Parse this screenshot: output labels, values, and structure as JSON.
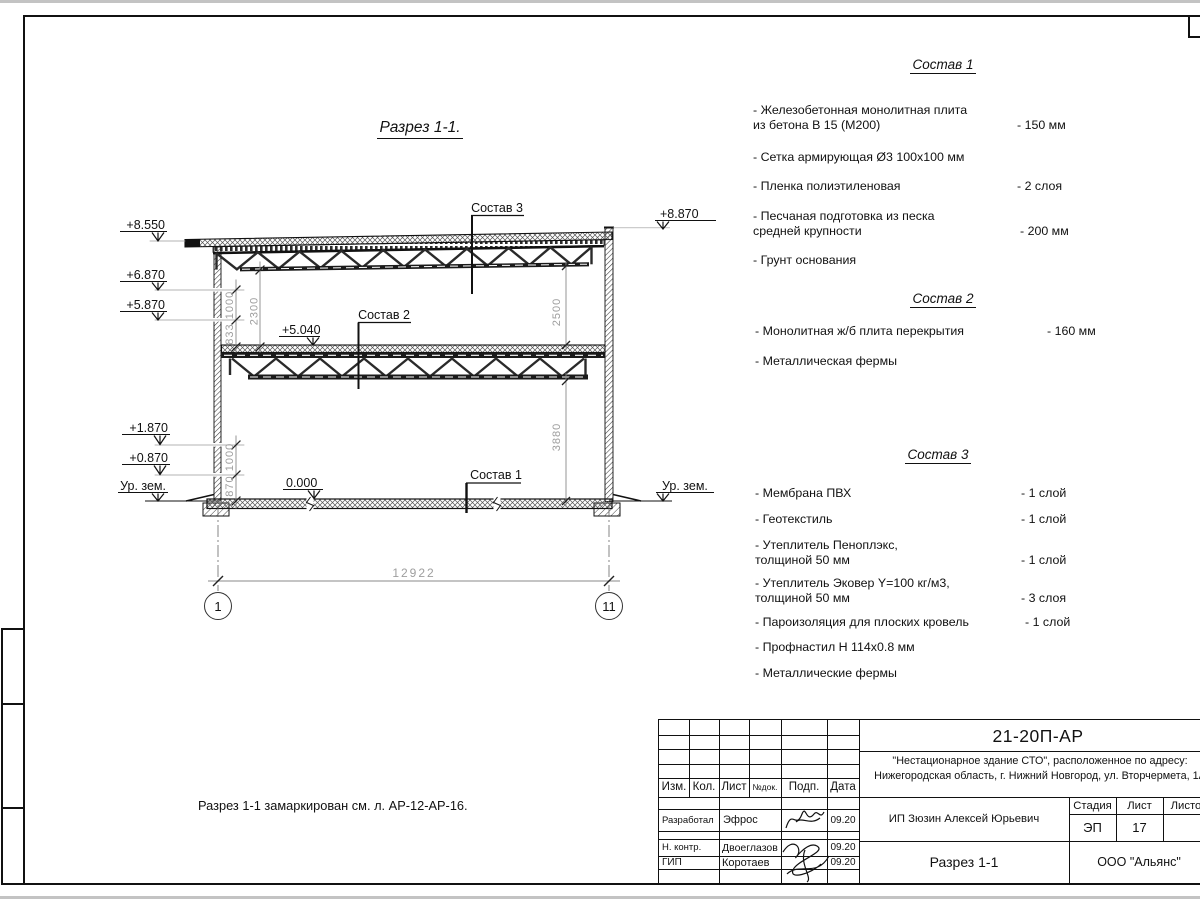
{
  "drawing": {
    "title": "Разрез 1-1.",
    "note": "Разрез 1-1 замаркирован см. л. АР-12-АР-16.",
    "callouts": {
      "sostav1": "Состав 1",
      "sostav2": "Состав 2",
      "sostav3": "Состав 3"
    },
    "elevations": {
      "left": [
        "+8.550",
        "+6.870",
        "+5.870",
        "+1.870",
        "+0.870",
        "Ур. зем."
      ],
      "right_top": "+8.870",
      "right_ground": "Ур. зем.",
      "mid_floor": "+5.040",
      "zero": "0.000"
    },
    "dimensions": {
      "span": "12922",
      "upper_left_1000": "1000",
      "upper_left_833": "833",
      "upper_left_2300": "2300",
      "lower_left_1000": "1000",
      "lower_left_870": "870",
      "right_2500": "2500",
      "right_3880": "3880"
    },
    "axes": {
      "left": "1",
      "right": "11"
    }
  },
  "compositions": [
    {
      "title": "Состав 1",
      "items": [
        {
          "text": "- Железобетонная  монолитная плита\nиз бетона В 15 (М200)",
          "value": "- 150 мм"
        },
        {
          "text": "- Сетка армирующая Ø3 100х100 мм",
          "value": ""
        },
        {
          "text": "- Пленка полиэтиленовая",
          "value": "-  2 слоя"
        },
        {
          "text": "- Песчаная подготовка из песка\nсредней крупности",
          "value": "- 200 мм"
        },
        {
          "text": "- Грунт основания",
          "value": ""
        }
      ]
    },
    {
      "title": "Состав 2",
      "items": [
        {
          "text": "- Монолитная ж/б плита перекрытия",
          "value": "- 160 мм"
        },
        {
          "text": "- Металлическая фермы",
          "value": ""
        }
      ]
    },
    {
      "title": "Состав 3",
      "items": [
        {
          "text": "- Мембрана ПВХ",
          "value": "- 1 слой"
        },
        {
          "text": "- Геотекстиль",
          "value": "- 1 слой"
        },
        {
          "text": "- Утеплитель Пеноплэкс,\nтолщиной 50 мм",
          "value": "- 1 слой"
        },
        {
          "text": "- Утеплитель Эковер Y=100 кг/м3,\nтолщиной 50 мм",
          "value": "- 3 слоя"
        },
        {
          "text": "- Пароизоляция для плоских кровель",
          "value": "- 1 слой"
        },
        {
          "text": "- Профнастил Н 114х0.8 мм",
          "value": ""
        },
        {
          "text": "- Металлические фермы",
          "value": ""
        }
      ]
    }
  ],
  "titleblock": {
    "doc_number": "21-20П-АР",
    "project_line1": "\"Нестационарное здание СТО\", расположенное по адресу:",
    "project_line2": "Нижегородская область, г. Нижний Новгород, ул. Вторчермета, 1А",
    "client": "ИП Зюзин Алексей Юрьевич",
    "sheet_title": "Разрез 1-1",
    "company": "ООО \"Альянс\"",
    "stage_label": "Стадия",
    "sheet_label": "Лист",
    "sheets_label": "Листов",
    "stage_value": "ЭП",
    "sheet_value": "17",
    "columns": [
      "Изм.",
      "Кол.",
      "Лист",
      "№док.",
      "Подп.",
      "Дата"
    ],
    "rows": [
      {
        "role": "Разработал",
        "name": "Эфрос",
        "date": "09.20"
      },
      {
        "role": "Н. контр.",
        "name": "Двоеглазов",
        "date": "09.20"
      },
      {
        "role": "ГИП",
        "name": "Коротаев",
        "date": "09.20"
      }
    ]
  },
  "colors": {
    "line": "#111111",
    "dim_text": "#9e9e9e",
    "paper": "#ffffff"
  }
}
